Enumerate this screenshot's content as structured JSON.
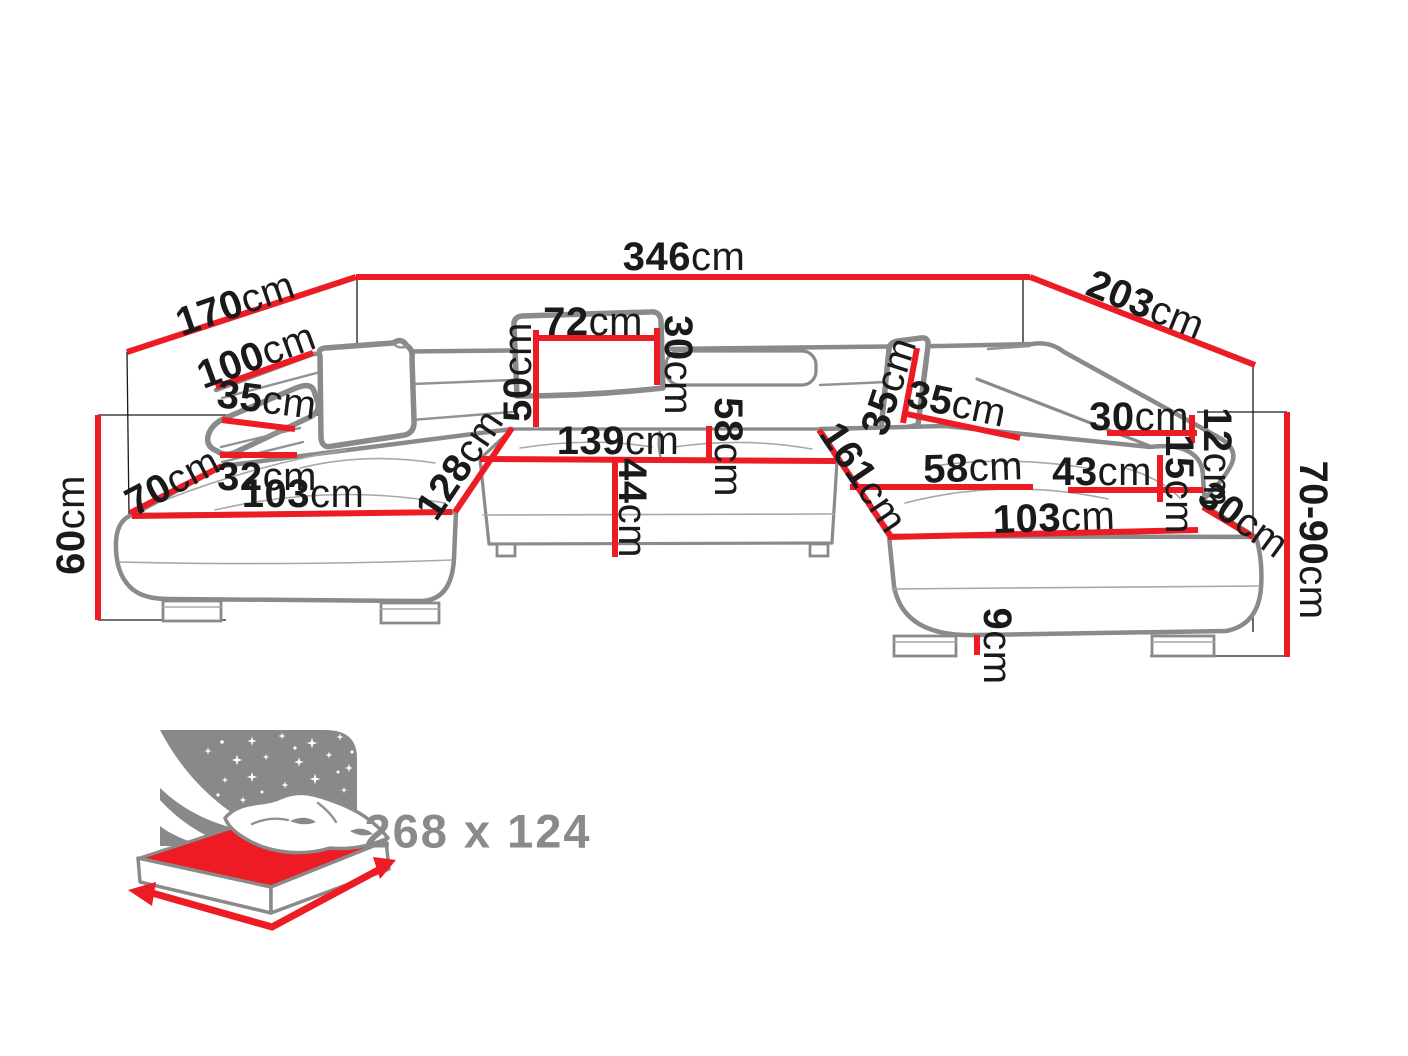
{
  "dimensions": {
    "total_width": {
      "value": "346",
      "unit": "cm"
    },
    "left_side_depth": {
      "value": "170",
      "unit": "cm"
    },
    "right_side_depth": {
      "value": "203",
      "unit": "cm"
    },
    "left_backrest_length": {
      "value": "100",
      "unit": "cm"
    },
    "left_armrest_width": {
      "value": "35",
      "unit": "cm"
    },
    "left_corner_width": {
      "value": "70",
      "unit": "cm"
    },
    "left_armrest_depth": {
      "value": "32",
      "unit": "cm"
    },
    "seat_height": {
      "value": "60",
      "unit": "cm"
    },
    "left_seat_length": {
      "value": "103",
      "unit": "cm"
    },
    "left_chaise_depth": {
      "value": "128",
      "unit": "cm"
    },
    "backrest_height": {
      "value": "50",
      "unit": "cm"
    },
    "headrest_width": {
      "value": "72",
      "unit": "cm"
    },
    "headrest_height": {
      "value": "30",
      "unit": "cm"
    },
    "middle_seat_width": {
      "value": "139",
      "unit": "cm"
    },
    "middle_seat_depth": {
      "value": "58",
      "unit": "cm"
    },
    "seat_front_height": {
      "value": "44",
      "unit": "cm"
    },
    "right_headrest_height": {
      "value": "35",
      "unit": "cm"
    },
    "right_headrest_width": {
      "value": "35",
      "unit": "cm"
    },
    "right_chaise_depth": {
      "value": "161",
      "unit": "cm"
    },
    "right_seat_depth": {
      "value": "58",
      "unit": "cm"
    },
    "right_armrest_depth": {
      "value": "43",
      "unit": "cm"
    },
    "right_armrest_top": {
      "value": "30",
      "unit": "cm"
    },
    "corner_edge_12": {
      "value": "12",
      "unit": "cm"
    },
    "corner_edge_15": {
      "value": "15",
      "unit": "cm"
    },
    "corner_edge_30": {
      "value": "30",
      "unit": "cm"
    },
    "adjustable_height": {
      "value": "70-90",
      "unit": "cm"
    },
    "right_seat_length": {
      "value": "103",
      "unit": "cm"
    },
    "leg_height": {
      "value": "9",
      "unit": "cm"
    }
  },
  "sleeping_area": {
    "label": "268 x 124"
  },
  "colors": {
    "dimension_line": "#ed1c24",
    "text": "#1a1a1a",
    "sofa_outline": "#8a8a8a",
    "bed_icon_gray": "#898989",
    "bed_mattress_red": "#ed1c24",
    "background": "#ffffff"
  }
}
